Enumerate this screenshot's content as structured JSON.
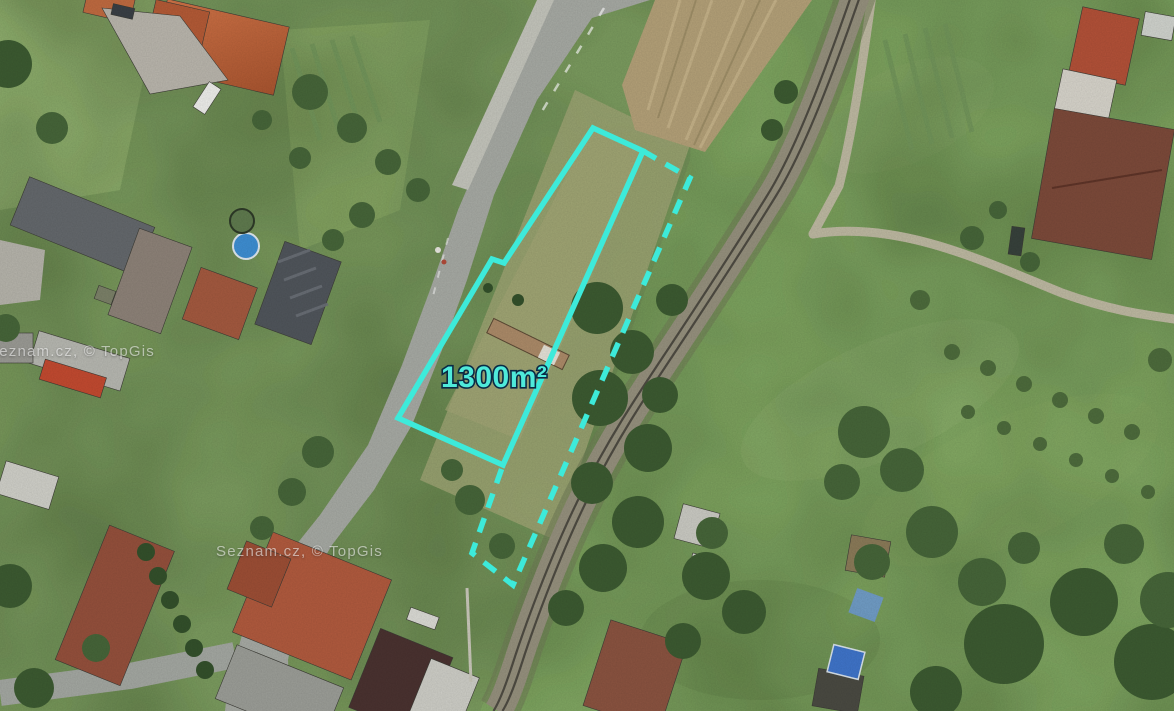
{
  "map": {
    "view": "aerial-satellite",
    "watermarks": [
      {
        "text": "Seznam.cz, © TopGis"
      },
      {
        "text": "Seznam.cz, © TopGis"
      }
    ],
    "parcel": {
      "area_label": "1300m²",
      "accent_color": "#3DEADA",
      "label_fill_color": "#4FEADA",
      "label_outline_color": "#0A2A44",
      "solid_outline_points": "593,128 643,151 503,465 398,418 492,259 504,263",
      "dashed_outline_points": "643,151 690,178 513,585 472,553 503,465"
    }
  }
}
